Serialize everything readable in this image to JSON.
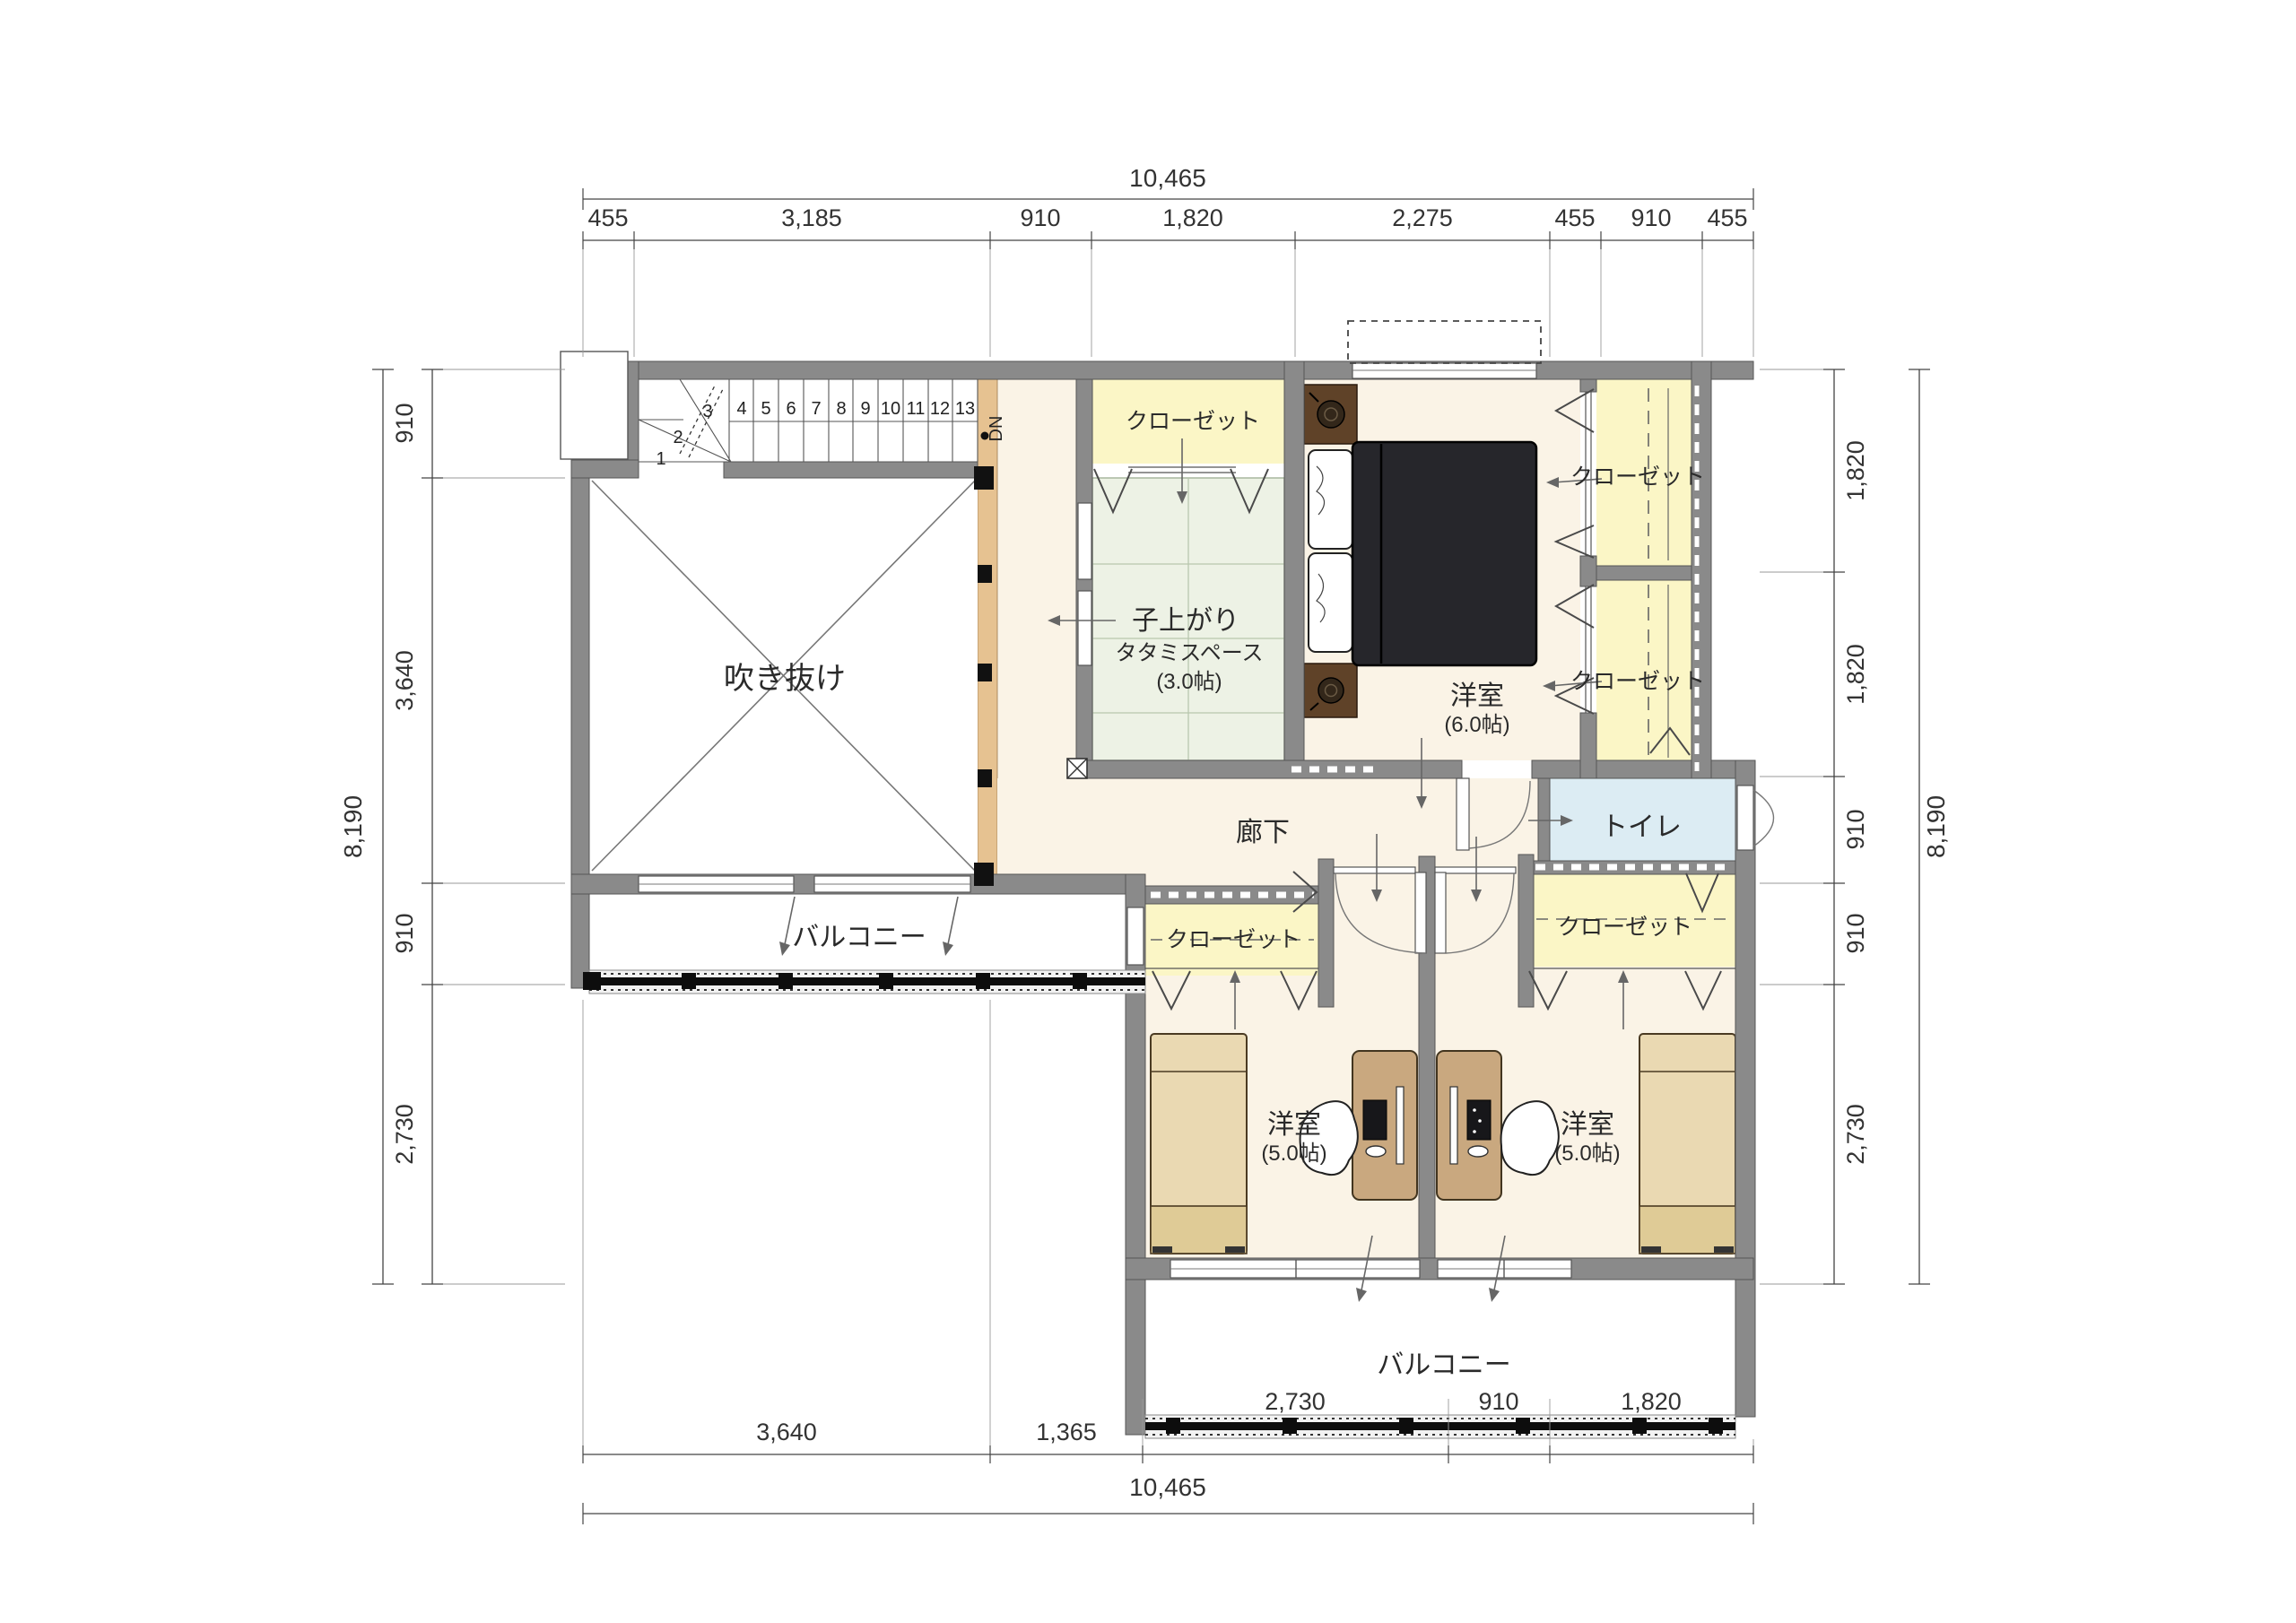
{
  "drawing": {
    "type": "floor-plan",
    "floor": "2F",
    "units": "mm"
  },
  "dims": {
    "top": {
      "total": "10,465",
      "segs": [
        "455",
        "3,185",
        "910",
        "1,820",
        "2,275",
        "455",
        "910",
        "455"
      ]
    },
    "bottom": {
      "total": "10,465",
      "segs": [
        "3,640",
        "1,365",
        "2,730",
        "910",
        "1,820"
      ]
    },
    "left": {
      "total": "8,190",
      "segs": [
        "910",
        "3,640",
        "910",
        "2,730"
      ]
    },
    "right": {
      "total": "8,190",
      "segs": [
        "1,820",
        "1,820",
        "910",
        "910",
        "2,730"
      ]
    }
  },
  "stairs": {
    "dn": "DN",
    "steps": [
      "1",
      "2",
      "3",
      "4",
      "5",
      "6",
      "7",
      "8",
      "9",
      "10",
      "11",
      "12",
      "13"
    ]
  },
  "rooms": {
    "void": "吹き抜け",
    "closet": "クローゼット",
    "tatami_line1": "子上がり",
    "tatami_line2": "タタミスペース",
    "tatami_size": "(3.0帖)",
    "master": "洋室",
    "master_size": "(6.0帖)",
    "hall": "廊下",
    "toilet": "トイレ",
    "balcony": "バルコニー",
    "kid": "洋室",
    "kid_size": "(5.0帖)"
  },
  "colors": {
    "wall": "#8a8a8a",
    "floor": "#faf3e6",
    "tatami": "#edf2e5",
    "closet": "#fbf6c6",
    "toilet": "#dcecf3",
    "edge_strip": "#e6c291",
    "bed_dark": "#26262b",
    "wood_brown": "#5f4228",
    "kid_bed": "#ead9b2",
    "desk": "#c9a87f"
  }
}
